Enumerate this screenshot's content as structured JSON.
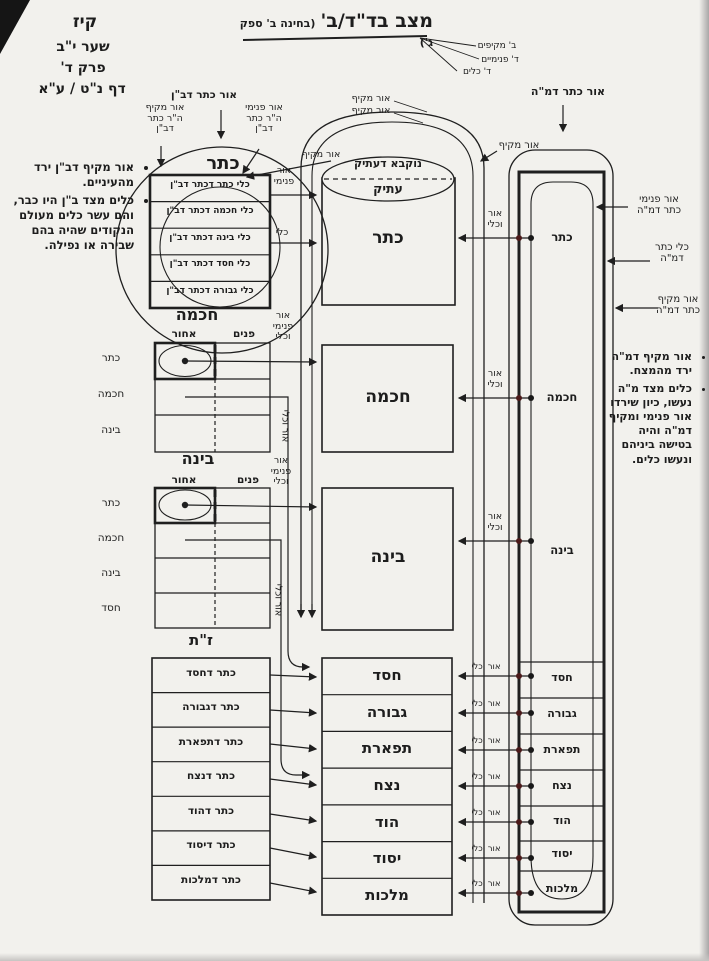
{
  "page_ref": {
    "folio": "קיז",
    "gate": "שער י\"ב",
    "chapter": "פרק ד'",
    "daf": "דף נ\"ט / ע\"א"
  },
  "title": {
    "main": "מצב בד\"ד/ב'",
    "sub": "(בחינה ב' ספק ג')",
    "pointer_labels": [
      "ב' מקיפים",
      "ד' פנימיים",
      "ד' כלים"
    ]
  },
  "notes_left": {
    "items": [
      "אור מקיף דב\"ן ירד מהעיניים.",
      "כלים מצד ב\"ן היו כבר, והם עשר כלים מעולם הנקודים שהיה בהם שבירה או נפילה."
    ]
  },
  "notes_right": {
    "items": [
      "אור מקיף דמ\"ה ירד מהמצח.",
      "כלים מצד מ\"ה נעשו, כיון שירדו אור פנימי ומקיף דמ\"ה והיה בטישה ביניהם ונעשו כלים."
    ]
  },
  "keter_ban": {
    "or_keter": "אור כתר דב\"ן",
    "or_makif_hr": "אור מקיף\nה\"ר כתר\nדב\"ן",
    "or_pnimi_hr": "אור פנימי\nה\"ר כתר\nדב\"ן",
    "or_makif": "אור מקיף",
    "title": "כתר",
    "rows": [
      "כלי כתר דכתר דב\"ן",
      "כלי חכמה דכתר דב\"ן",
      "כלי בינה דכתר דב\"ן",
      "כלי חסד דכתר דב\"ן",
      "כלי גבורה דכתר דב\"ן"
    ],
    "arrow_or_pnimi": "אור\nפנימי",
    "arrow_kli": "כלי"
  },
  "chochma_ban": {
    "title": "חכמה",
    "back": "אחור",
    "front": "פנים",
    "rows": [
      "כתר",
      "חכמה",
      "בינה"
    ],
    "side": "אור\nפנימי\nוכלי",
    "vert": "אור וכלי"
  },
  "bina_ban": {
    "title": "בינה",
    "back": "אחור",
    "front": "פנים",
    "rows": [
      "כתר",
      "חכמה",
      "בינה",
      "חסד"
    ],
    "side": "אור\nפנימי\nוכלי",
    "vert": "אור וכלי"
  },
  "zat": {
    "title": "ז\"ת",
    "rows": [
      "כתר דחסד",
      "כתר דגבורה",
      "כתר דתפארת",
      "כתר דנצח",
      "כתר דהוד",
      "כתר דיסוד",
      "כתר דמלכות"
    ]
  },
  "middle": {
    "or_makif_a": "אור מקיף",
    "or_makif_b": "אור מקיף",
    "or_makif_c": "אור מקיף",
    "ellipse_top": "נוקבא דעתיק",
    "ellipse_bottom": "עתיק",
    "keter": "כתר",
    "chochma": "חכמה",
    "bina": "בינה",
    "stack": [
      "חסד",
      "גבורה",
      "תפארת",
      "נצח",
      "הוד",
      "יסוד",
      "מלכות"
    ]
  },
  "right_col": {
    "top": "אור כתר דמ\"ה",
    "side_pnimi": "אור פנימי\nכתר דמ\"ה",
    "side_kli": "כלי כתר\nדמ\"ה",
    "side_makif": "אור מקיף\nכתר דמ\"ה",
    "upper": [
      "כתר",
      "חכמה",
      "בינה"
    ],
    "lower": [
      "חסד",
      "גבורה",
      "תפארת",
      "נצח",
      "הוד",
      "יסוד",
      "מלכות"
    ],
    "arrow_label_stacked": "אור\nוכלי",
    "arrow_label": "אור וכלי"
  }
}
